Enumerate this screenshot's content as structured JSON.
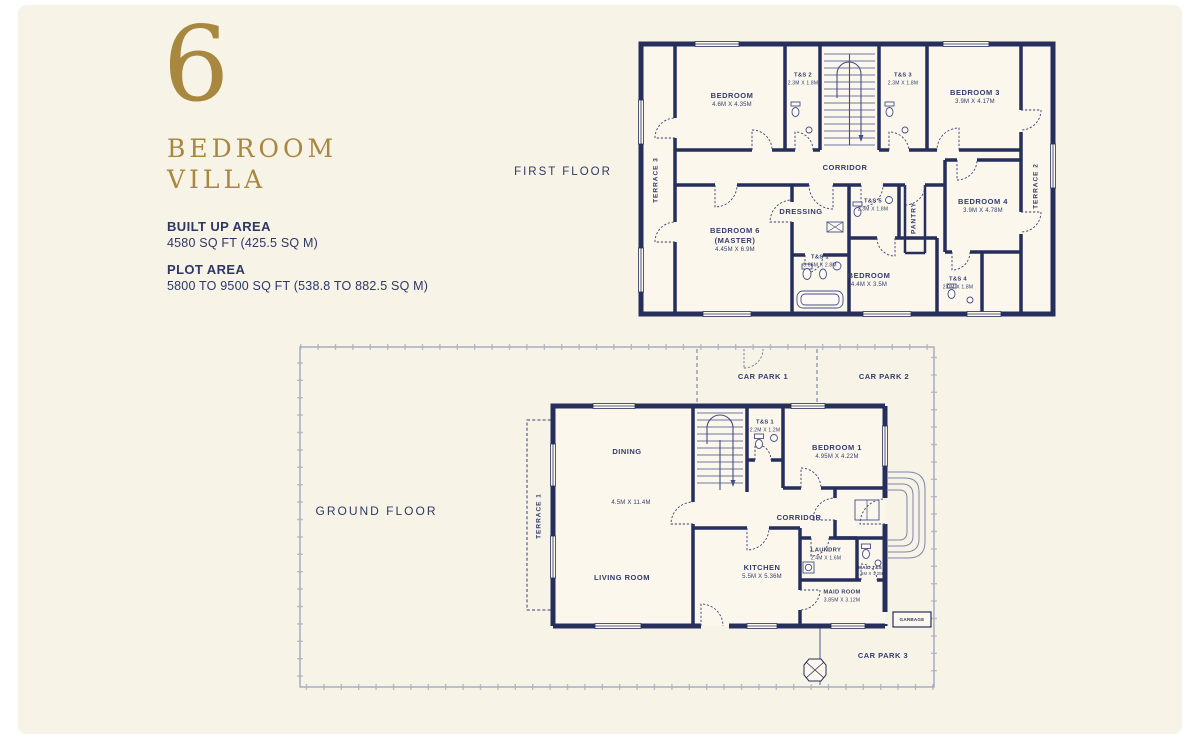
{
  "colors": {
    "background": "#f8f3e7",
    "wall_navy": "#262f5c",
    "gold": "#a8873e",
    "text_navy": "#2c3766",
    "plot_line": "#9aa3ba"
  },
  "info": {
    "number": "6",
    "title_line1": "BEDROOM",
    "title_line2": "VILLA",
    "built_up_area_label": "BUILT UP AREA",
    "built_up_area_value": "4580 SQ FT (425.5 SQ M)",
    "plot_area_label": "PLOT AREA",
    "plot_area_value": "5800 TO 9500 SQ FT (538.8 TO 882.5 SQ M)"
  },
  "first_floor": {
    "title": "FIRST FLOOR",
    "terrace_left": {
      "name": "TERRACE 3"
    },
    "terrace_right": {
      "name": "TERRACE 2"
    },
    "rooms": {
      "bedroom_top_left": {
        "name": "BEDROOM",
        "dims": "4.6M X 4.35M"
      },
      "ts2": {
        "name": "T&S 2",
        "dims": "2.3M X 1.8M"
      },
      "ts3": {
        "name": "T&S 3",
        "dims": "2.3M X 1.8M"
      },
      "bedroom3": {
        "name": "BEDROOM 3",
        "dims": "3.9M X 4.17M"
      },
      "corridor": {
        "name": "CORRIDOR"
      },
      "dressing": {
        "name": "DRESSING"
      },
      "ts5": {
        "name": "T&S 5",
        "dims": "2.3M X 1.8M"
      },
      "pantry": {
        "name": "PANTRY"
      },
      "bedroom6": {
        "name": "BEDROOM 6",
        "name2": "(MASTER)",
        "dims": "4.45M X 6.9M"
      },
      "ts1": {
        "name": "T&S 1",
        "dims": "3.66M X 2.8M"
      },
      "bedroom_mid": {
        "name": "BEDROOM",
        "dims": "4.4M X 3.5M"
      },
      "ts4": {
        "name": "T&S 4",
        "dims": "2.0M X 1.8M"
      },
      "bedroom4": {
        "name": "BEDROOM 4",
        "dims": "3.9M X 4.78M"
      }
    }
  },
  "ground_floor": {
    "title": "GROUND FLOOR",
    "terrace": {
      "name": "TERRACE 1"
    },
    "rooms": {
      "car_park_1": {
        "name": "CAR PARK 1"
      },
      "car_park_2": {
        "name": "CAR PARK 2"
      },
      "car_park_3": {
        "name": "CAR PARK 3"
      },
      "ts": {
        "name": "T&S 1",
        "dims": "2.2M X 1.2M"
      },
      "bedroom1": {
        "name": "BEDROOM 1",
        "dims": "4.95M X 4.22M"
      },
      "dining": {
        "name": "DINING"
      },
      "dining_living_dims": "4.5M X 11.4M",
      "corridor": {
        "name": "CORRIDOR"
      },
      "living": {
        "name": "LIVING ROOM"
      },
      "kitchen": {
        "name": "KITCHEN",
        "dims": "5.5M X 5.36M"
      },
      "laundry": {
        "name": "LAUNDRY",
        "dims": "2.4M X 1.6M"
      },
      "maid_ts": {
        "name": "MAID T&S",
        "dims": "1.8M X 1.2M"
      },
      "maid_room": {
        "name": "MAID ROOM",
        "dims": "3.85M X 3.12M"
      },
      "garbage": {
        "name": "GARBAGE"
      }
    }
  }
}
